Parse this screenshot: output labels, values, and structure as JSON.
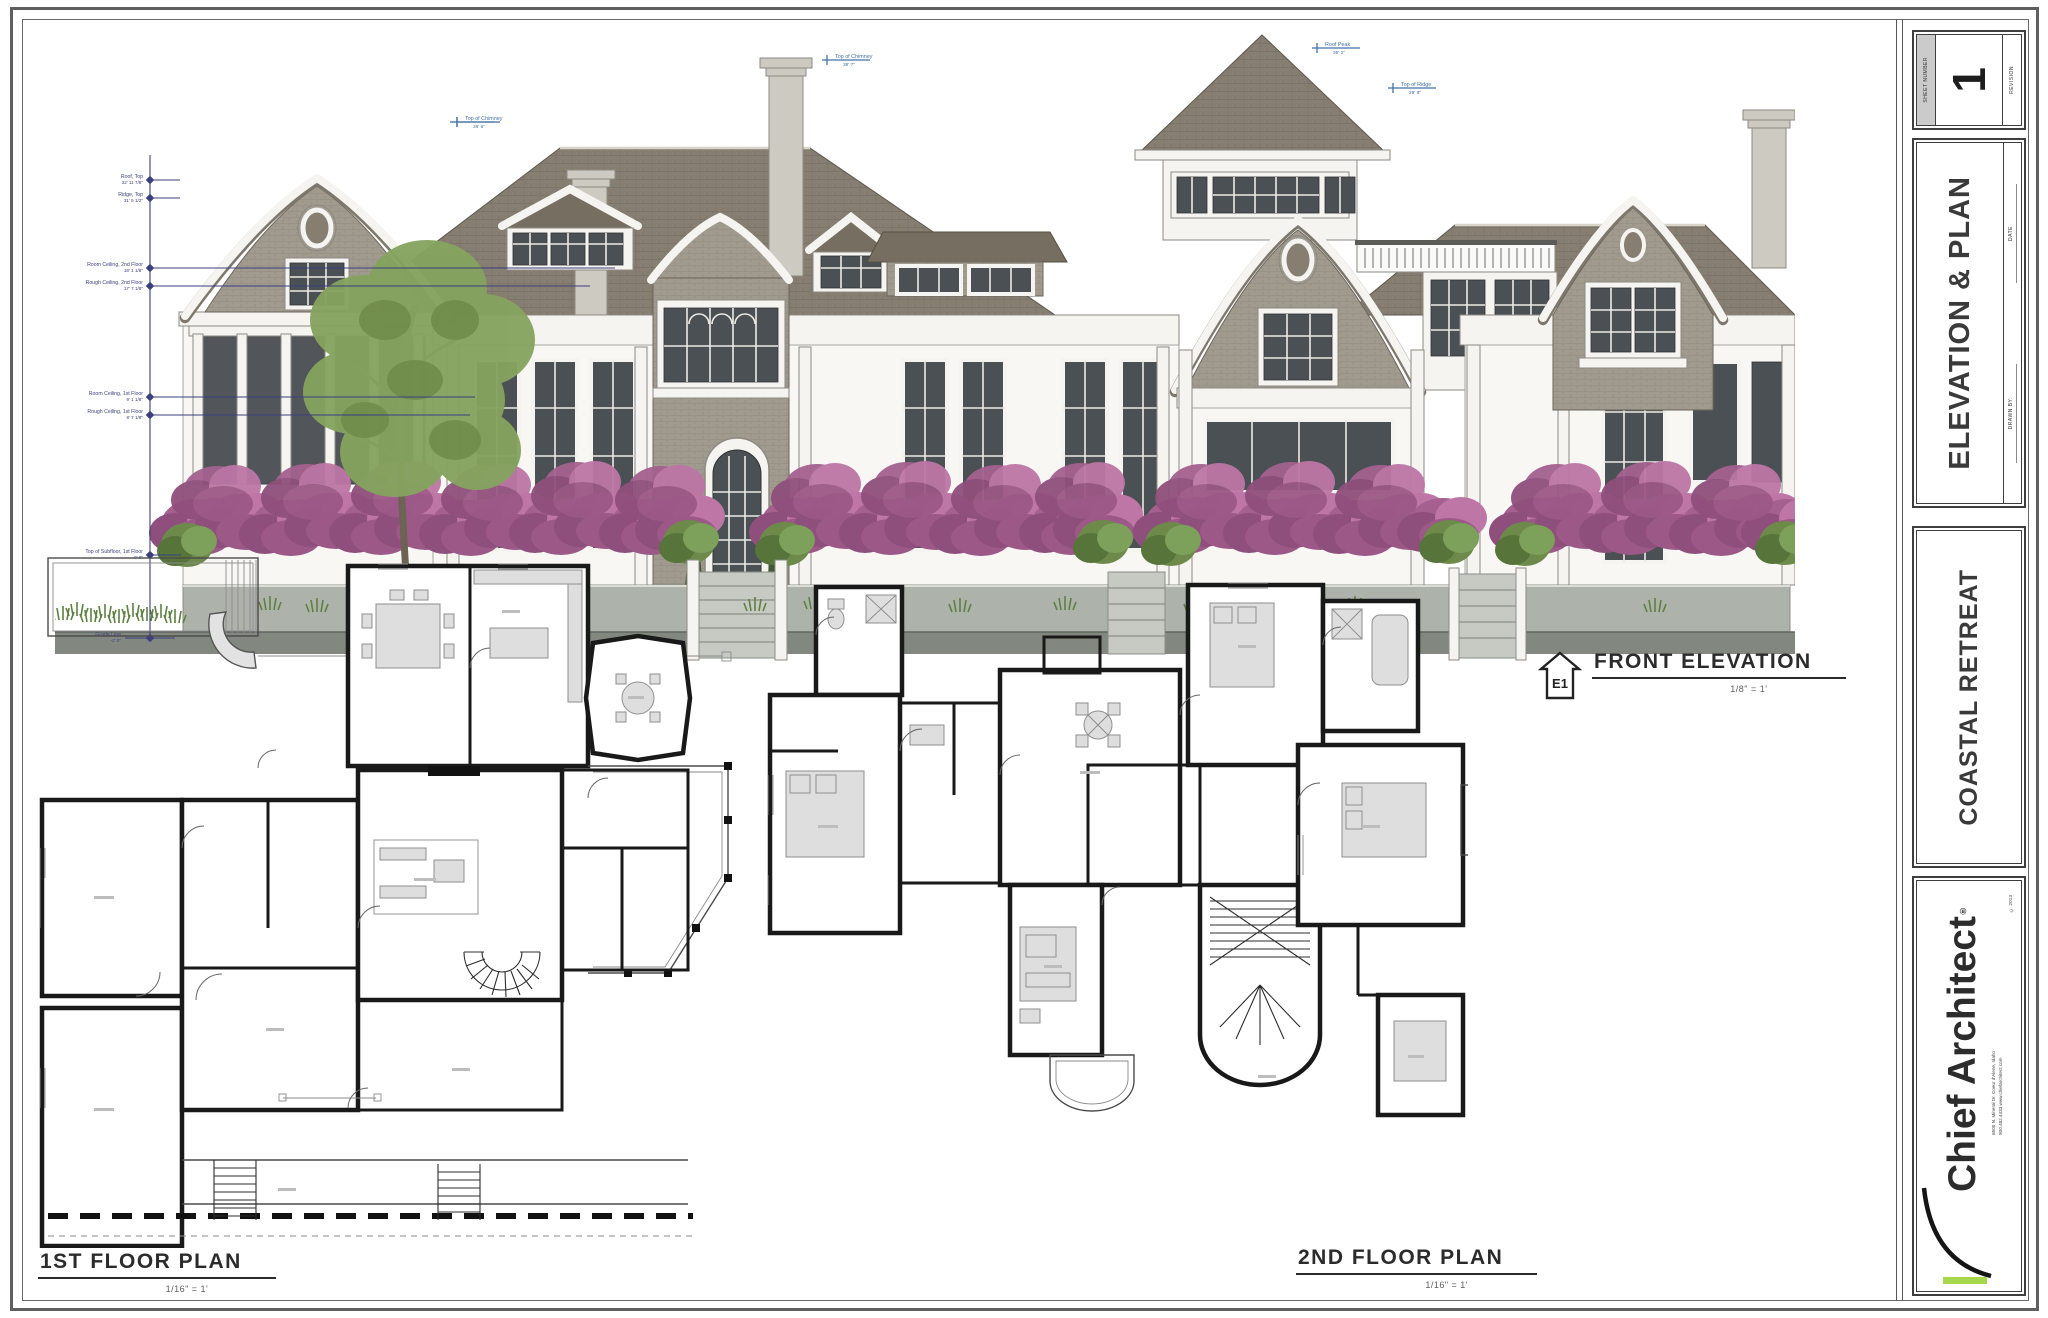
{
  "sheet": {
    "background": "#ffffff",
    "border_color": "#5f5f5f"
  },
  "title_block": {
    "sheet_number_label": "SHEET NUMBER",
    "sheet_number": "1",
    "revision_label": "REVISION",
    "section_title": "ELEVATION & PLAN",
    "date_label": "DATE",
    "drawn_by_label": "DRAWN BY:",
    "project_title": "COASTAL RETREAT",
    "brand_name": "Chief Architect",
    "brand_mark": "®",
    "brand_address_line1": "6500 N. Mineral Dr.   Coeur d'Alene, Idaho",
    "brand_address_line2": "800.482.4433    www.chiefarchitect.com",
    "brand_copyright": "© 2013",
    "logo_green": "#a6d74d"
  },
  "elevation": {
    "label": "FRONT ELEVATION",
    "tag": "E1",
    "scale": "1/8\" = 1'",
    "callouts": [
      {
        "label": "Top of Chimney",
        "value": "28' 6\""
      },
      {
        "label": "Top of Chimney",
        "value": "38' 7\""
      },
      {
        "label": "Roof Peak",
        "value": "35' 2\""
      },
      {
        "label": "Top of Ridge",
        "value": "29' 8\""
      }
    ],
    "dimensions": [
      {
        "label": "Roof, Top",
        "value": "32' 11 7/8\""
      },
      {
        "label": "Ridge, Top",
        "value": "31' 5 1/2\""
      },
      {
        "label": "Room Ceiling, 2nd Floor",
        "value": "18' 1 1/8\""
      },
      {
        "label": "Rough Ceiling, 2nd Floor",
        "value": "17' 7 1/8\""
      },
      {
        "label": "Room Ceiling, 1st Floor",
        "value": "9' 1 1/8\""
      },
      {
        "label": "Rough Ceiling, 1st Floor",
        "value": "8' 7 1/8\""
      },
      {
        "label": "Top of Subfloor, 1st Floor",
        "value": "0' 0\""
      },
      {
        "label": "Grade Line",
        "value": "-2' 0\""
      }
    ]
  },
  "plans": {
    "first_floor": {
      "label": "1ST FLOOR PLAN",
      "scale": "1/16\" = 1'"
    },
    "second_floor": {
      "label": "2ND FLOOR PLAN",
      "scale": "1/16\" = 1'"
    }
  },
  "palette": {
    "roof": "#8b8175",
    "shingle_wall": "#a09a8f",
    "trim_white": "#f5f4f0",
    "window": "#4b5054",
    "hedge_pink": "#a4618f",
    "foliage_green": "#85a35f",
    "ground_gray": "#adb2aa",
    "dimension_blue": "#3b3f7e",
    "callout_blue": "#4272a8"
  }
}
